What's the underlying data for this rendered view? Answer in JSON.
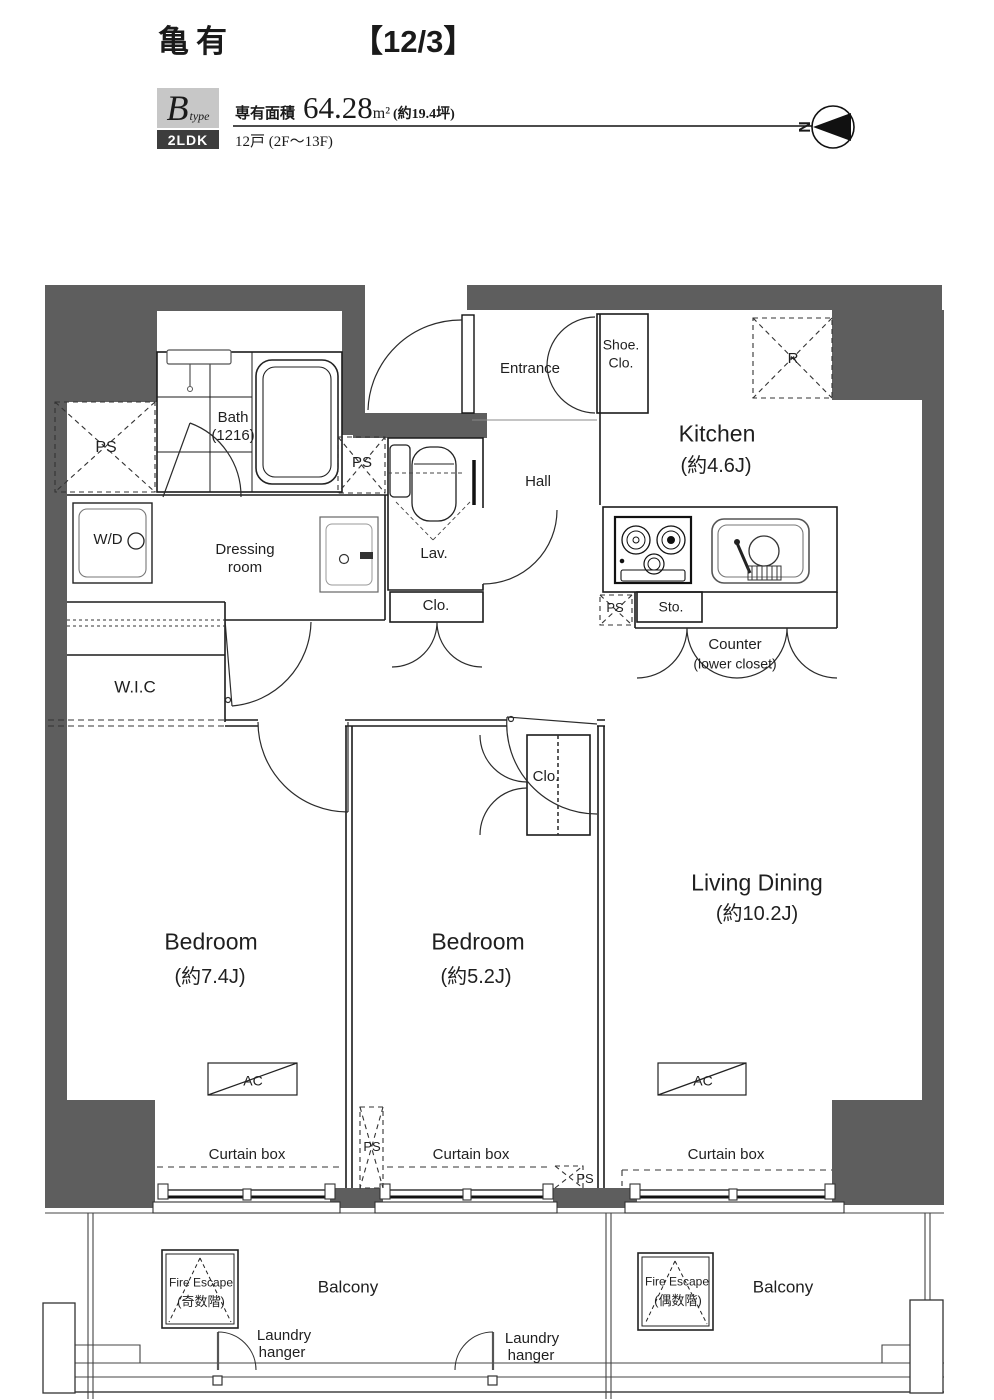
{
  "header": {
    "title": "亀有",
    "date": "【12/3】"
  },
  "type_info": {
    "type_letter": "B",
    "type_suffix": "type",
    "area_label": "専有面積",
    "area_value": "64.28",
    "area_unit": "m²",
    "area_tsubo": "(約19.4坪)",
    "layout": "2LDK",
    "units": "12戸 (2F～13F)"
  },
  "compass": {
    "north": "N"
  },
  "plan": {
    "entrance": "Entrance",
    "shoe_closet_line1": "Shoe.",
    "shoe_closet_line2": "Clo.",
    "kitchen_line1": "Kitchen",
    "kitchen_line2": "(約4.6J)",
    "refrigerator": "R",
    "hall": "Hall",
    "bath_line1": "Bath",
    "bath_line2": "(1216)",
    "ps": "PS",
    "washer_dryer": "W/D",
    "dressing_line1": "Dressing",
    "dressing_line2": "room",
    "lavatory": "Lav.",
    "closet": "Clo.",
    "wic": "W.I.C",
    "storage": "Sto.",
    "counter_line1": "Counter",
    "counter_line2": "(lower closet)",
    "living_line1": "Living Dining",
    "living_line2": "(約10.2J)",
    "bedroom1_line1": "Bedroom",
    "bedroom1_line2": "(約7.4J)",
    "bedroom2_line1": "Bedroom",
    "bedroom2_line2": "(約5.2J)",
    "ac": "AC",
    "curtain_box": "Curtain box",
    "fire_escape": "Fire Escape",
    "fire_escape_odd": "(奇数階)",
    "fire_escape_even": "(偶数階)",
    "balcony": "Balcony",
    "laundry_line1": "Laundry",
    "laundry_line2": "hanger"
  },
  "colors": {
    "wall": "#5e5e5e",
    "type_box_bg": "#c7c7c7",
    "layout_box_bg": "#3d3d3d"
  }
}
